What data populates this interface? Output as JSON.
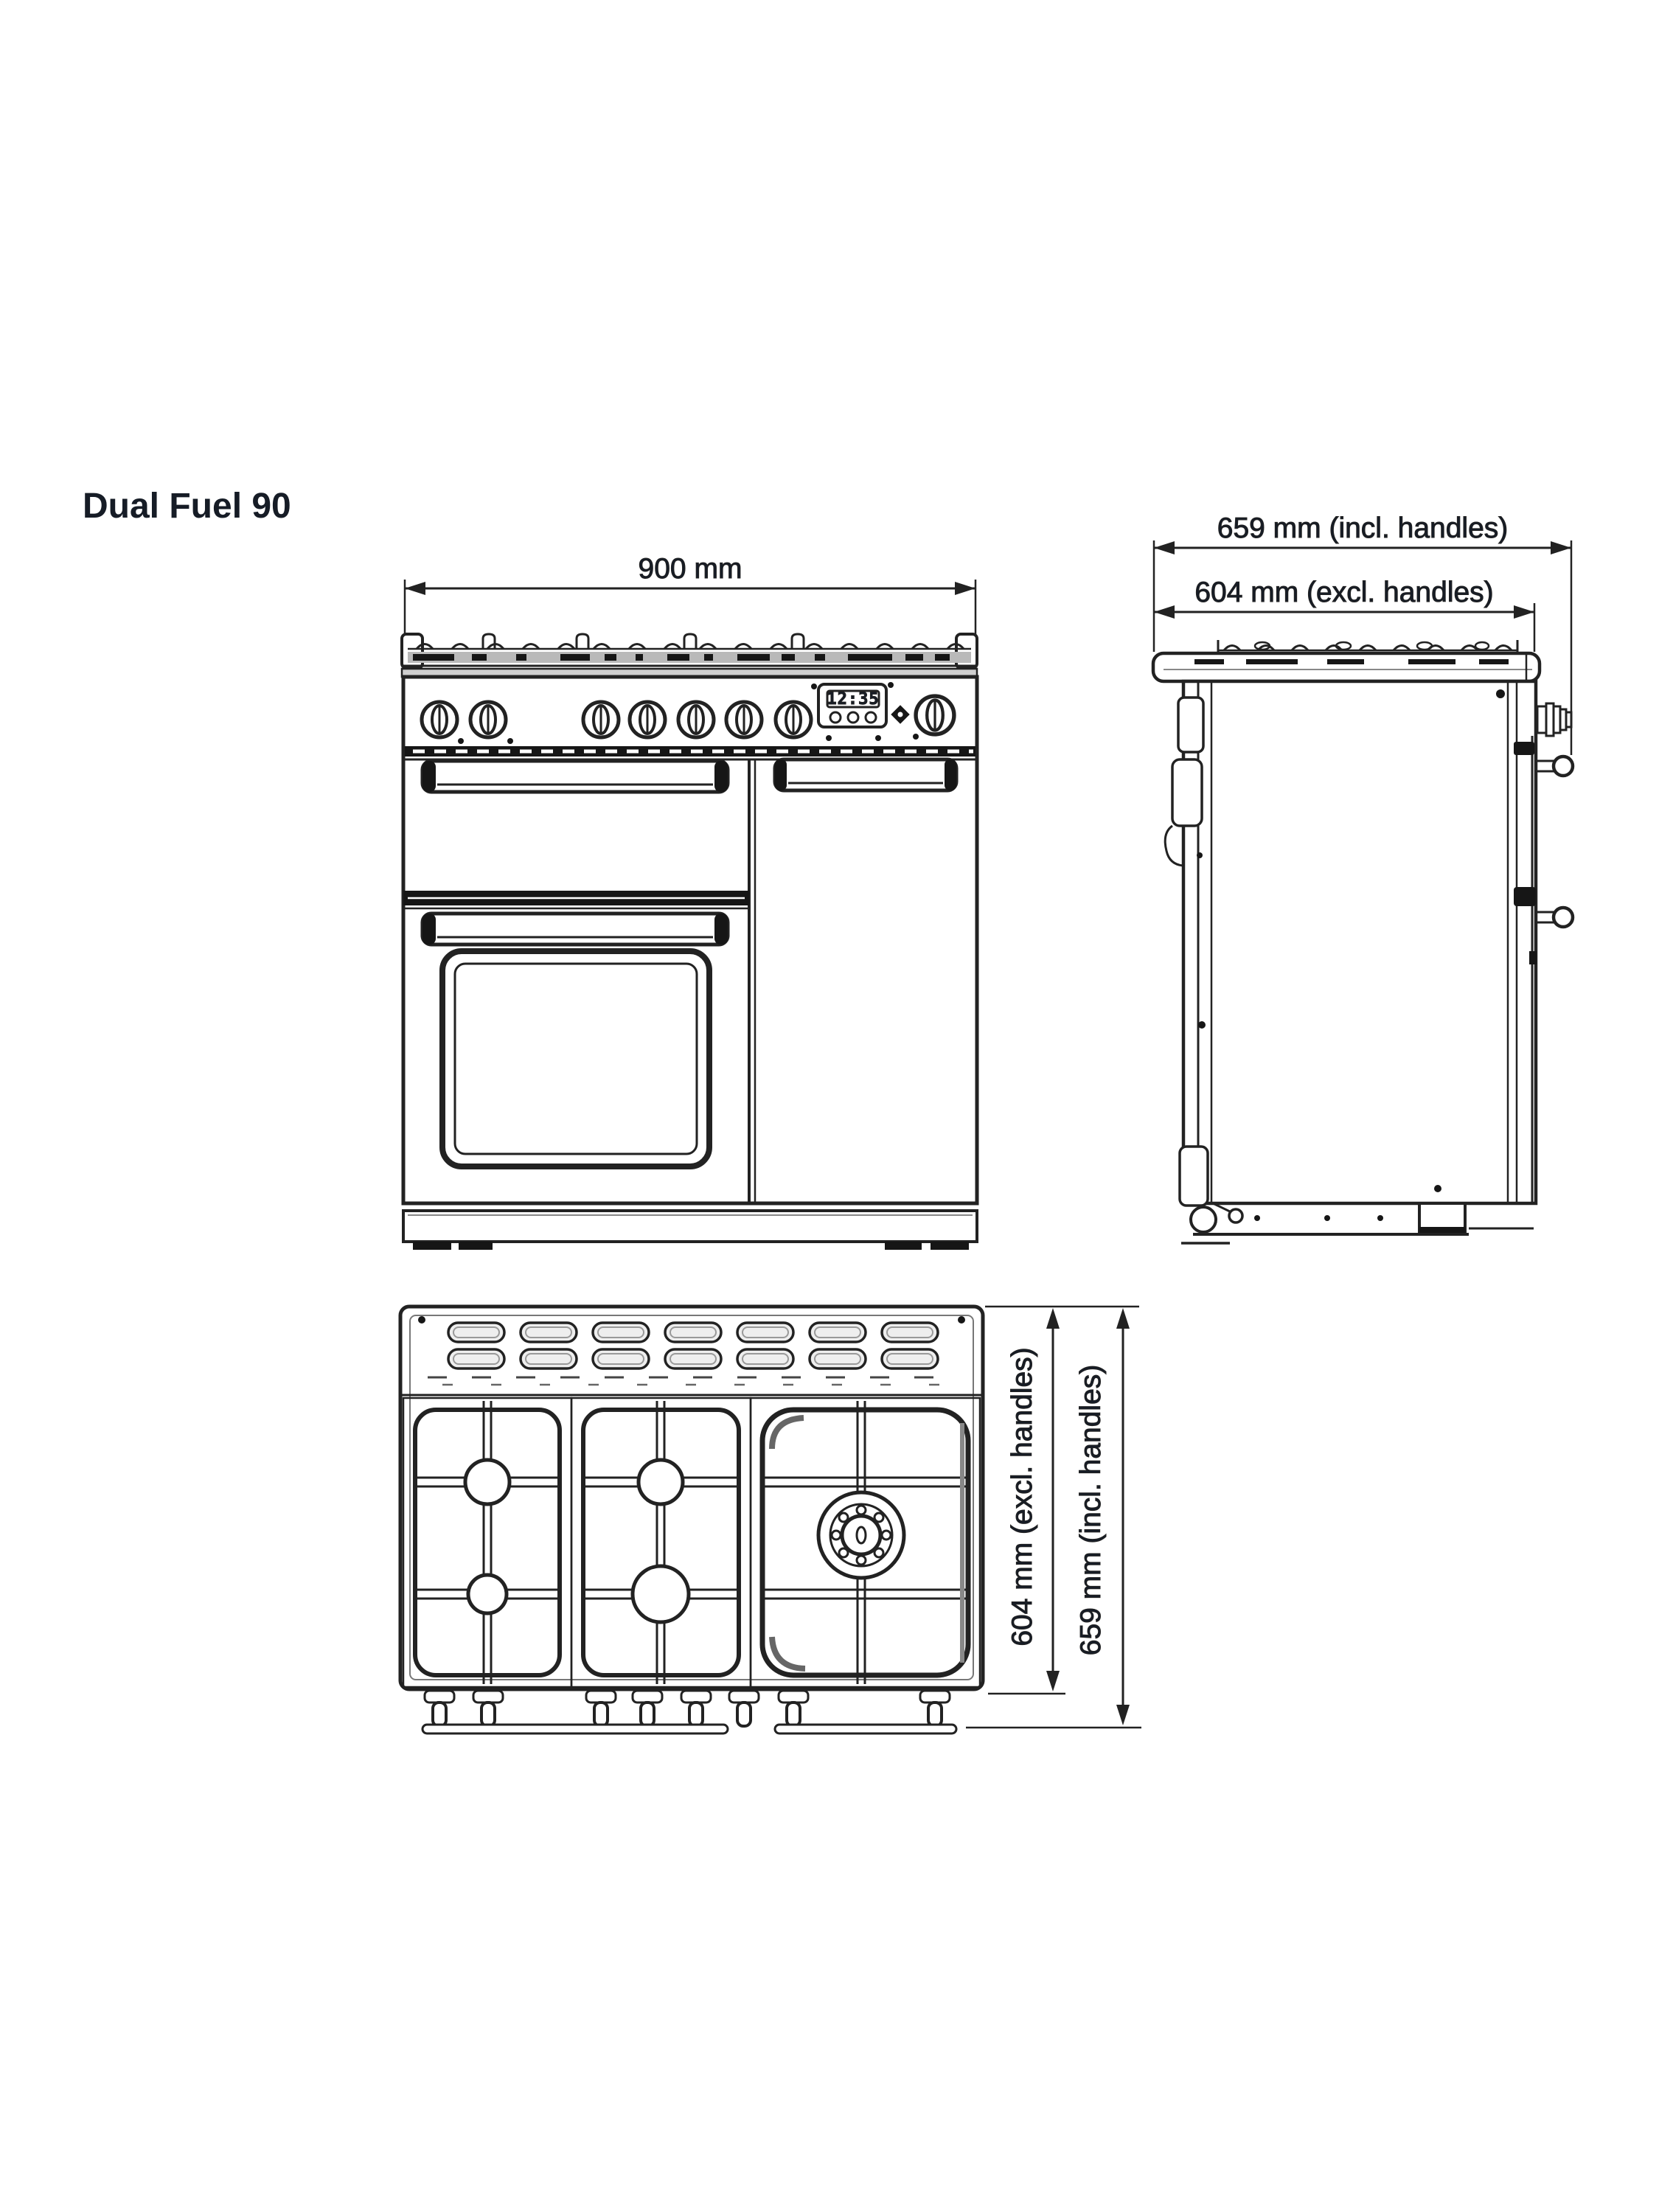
{
  "title": "Dual Fuel 90",
  "colors": {
    "ink": "#222222",
    "text": "#161c26",
    "background": "#ffffff"
  },
  "front_view": {
    "name": "front elevation",
    "width_label": "900 mm",
    "display_time": "12:35"
  },
  "side_view": {
    "name": "side elevation",
    "depth_incl_label": "659 mm (incl. handles)",
    "depth_excl_label": "604 mm (excl. handles)"
  },
  "top_view": {
    "name": "plan view",
    "depth_excl_label": "604 mm (excl. handles)",
    "depth_incl_label": "659 mm (incl. handles)"
  }
}
